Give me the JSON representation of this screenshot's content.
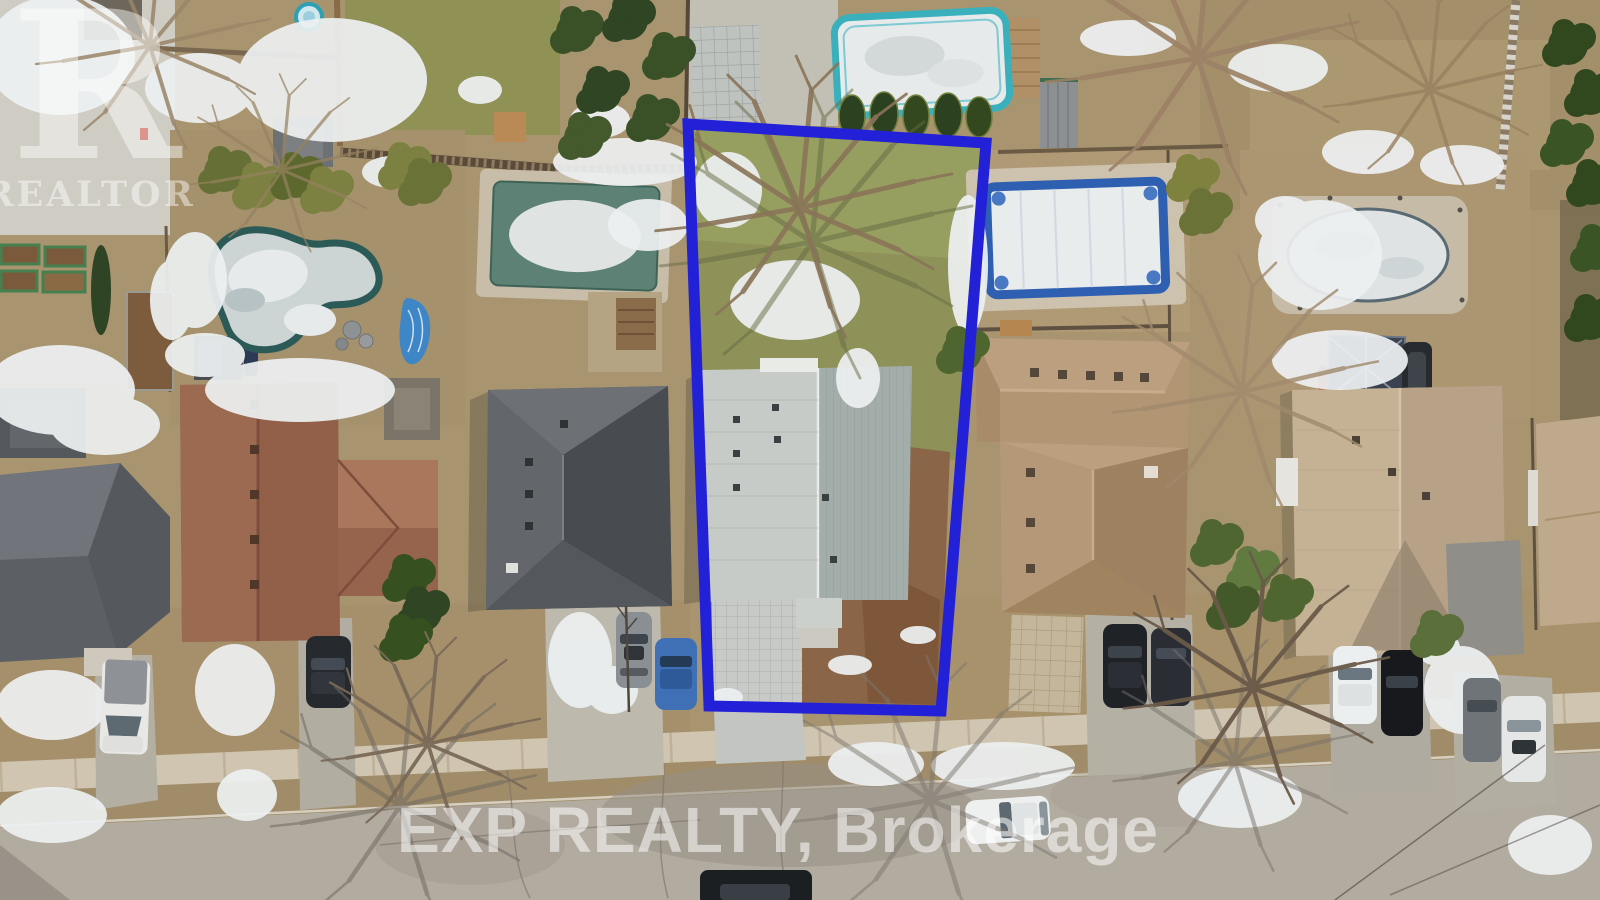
{
  "image": {
    "kind": "aerial drone photograph",
    "caption": "Winter aerial view of a suburban residential street with one lot outlined in blue",
    "conditions": "patchy snow on lawns, frozen pools, bare trees"
  },
  "watermarks": {
    "logo_letter": "R",
    "logo_caption": "REALTOR",
    "road_text": "EXP REALTY, Brokerage"
  },
  "annotation": {
    "name": "property-boundary-outline",
    "shape": "quadrilateral",
    "color": "#2321d8"
  },
  "palette": {
    "snow": "#edf0f1",
    "road": "#b2aba0",
    "sidewalk": "#d0c5b0",
    "boulevard_grass": "#a08c68",
    "dead_grass": "#a8946f",
    "green_lawn": "#8f9155",
    "dirt": "#8a6548"
  },
  "houses": [
    {
      "id": "house-small-dark",
      "roof": "#54575c"
    },
    {
      "id": "house-far-left",
      "roof": "#66696d"
    },
    {
      "id": "house-red-brown",
      "roof": "#925f49"
    },
    {
      "id": "house-dark-gray",
      "roof": "#585b5f"
    },
    {
      "id": "subject-house",
      "roof": "#c6cbc7",
      "outlined": true
    },
    {
      "id": "house-tan",
      "roof": "#b29573"
    },
    {
      "id": "house-beige",
      "roof": "#c5b194"
    },
    {
      "id": "house-right-edge",
      "roof": "#bfa98c"
    }
  ],
  "pools": [
    {
      "id": "freeform-pond-pool",
      "rim": "#2c5a57",
      "state": "frozen"
    },
    {
      "id": "covered-rect-pool",
      "cover": "#5d8174",
      "state": "covered"
    },
    {
      "id": "above-ground-pool",
      "rim": "#3ab0bd",
      "state": "frozen"
    },
    {
      "id": "blue-liner-pool",
      "liner": "#2f5fb0",
      "state": "frozen"
    },
    {
      "id": "oval-pool",
      "ice": "#dfe3e3",
      "state": "frozen"
    }
  ],
  "vehicles": [
    {
      "id": "white-van",
      "color": "#e8e8e6"
    },
    {
      "id": "dark-suv-left",
      "color": "#26292e"
    },
    {
      "id": "gray-car",
      "color": "#8a8f94"
    },
    {
      "id": "blue-car",
      "color": "#3f6fb5"
    },
    {
      "id": "dark-suv-right-1",
      "color": "#1f2328"
    },
    {
      "id": "dark-suv-right-2",
      "color": "#2a2e34"
    },
    {
      "id": "white-car-right",
      "color": "#eceff0"
    },
    {
      "id": "dark-car-right",
      "color": "#17191d"
    },
    {
      "id": "gray-suv-far-right",
      "color": "#6f7478"
    },
    {
      "id": "white-car-far-right",
      "color": "#e5e7e6"
    },
    {
      "id": "white-car-on-road",
      "color": "#eef0ef"
    },
    {
      "id": "dark-car-bottom",
      "color": "#1c1f22"
    }
  ],
  "features": [
    "freeform pond pool",
    "covered rectangular pool",
    "above-ground pool",
    "blue in-ground pool",
    "oval pool",
    "raised garden beds",
    "vegetable garden",
    "garden sheds",
    "wood deck",
    "gazebo",
    "paver patio",
    "paver driveway",
    "sidewalk",
    "boulevard snow piles",
    "bare winter trees",
    "cedar trees"
  ]
}
